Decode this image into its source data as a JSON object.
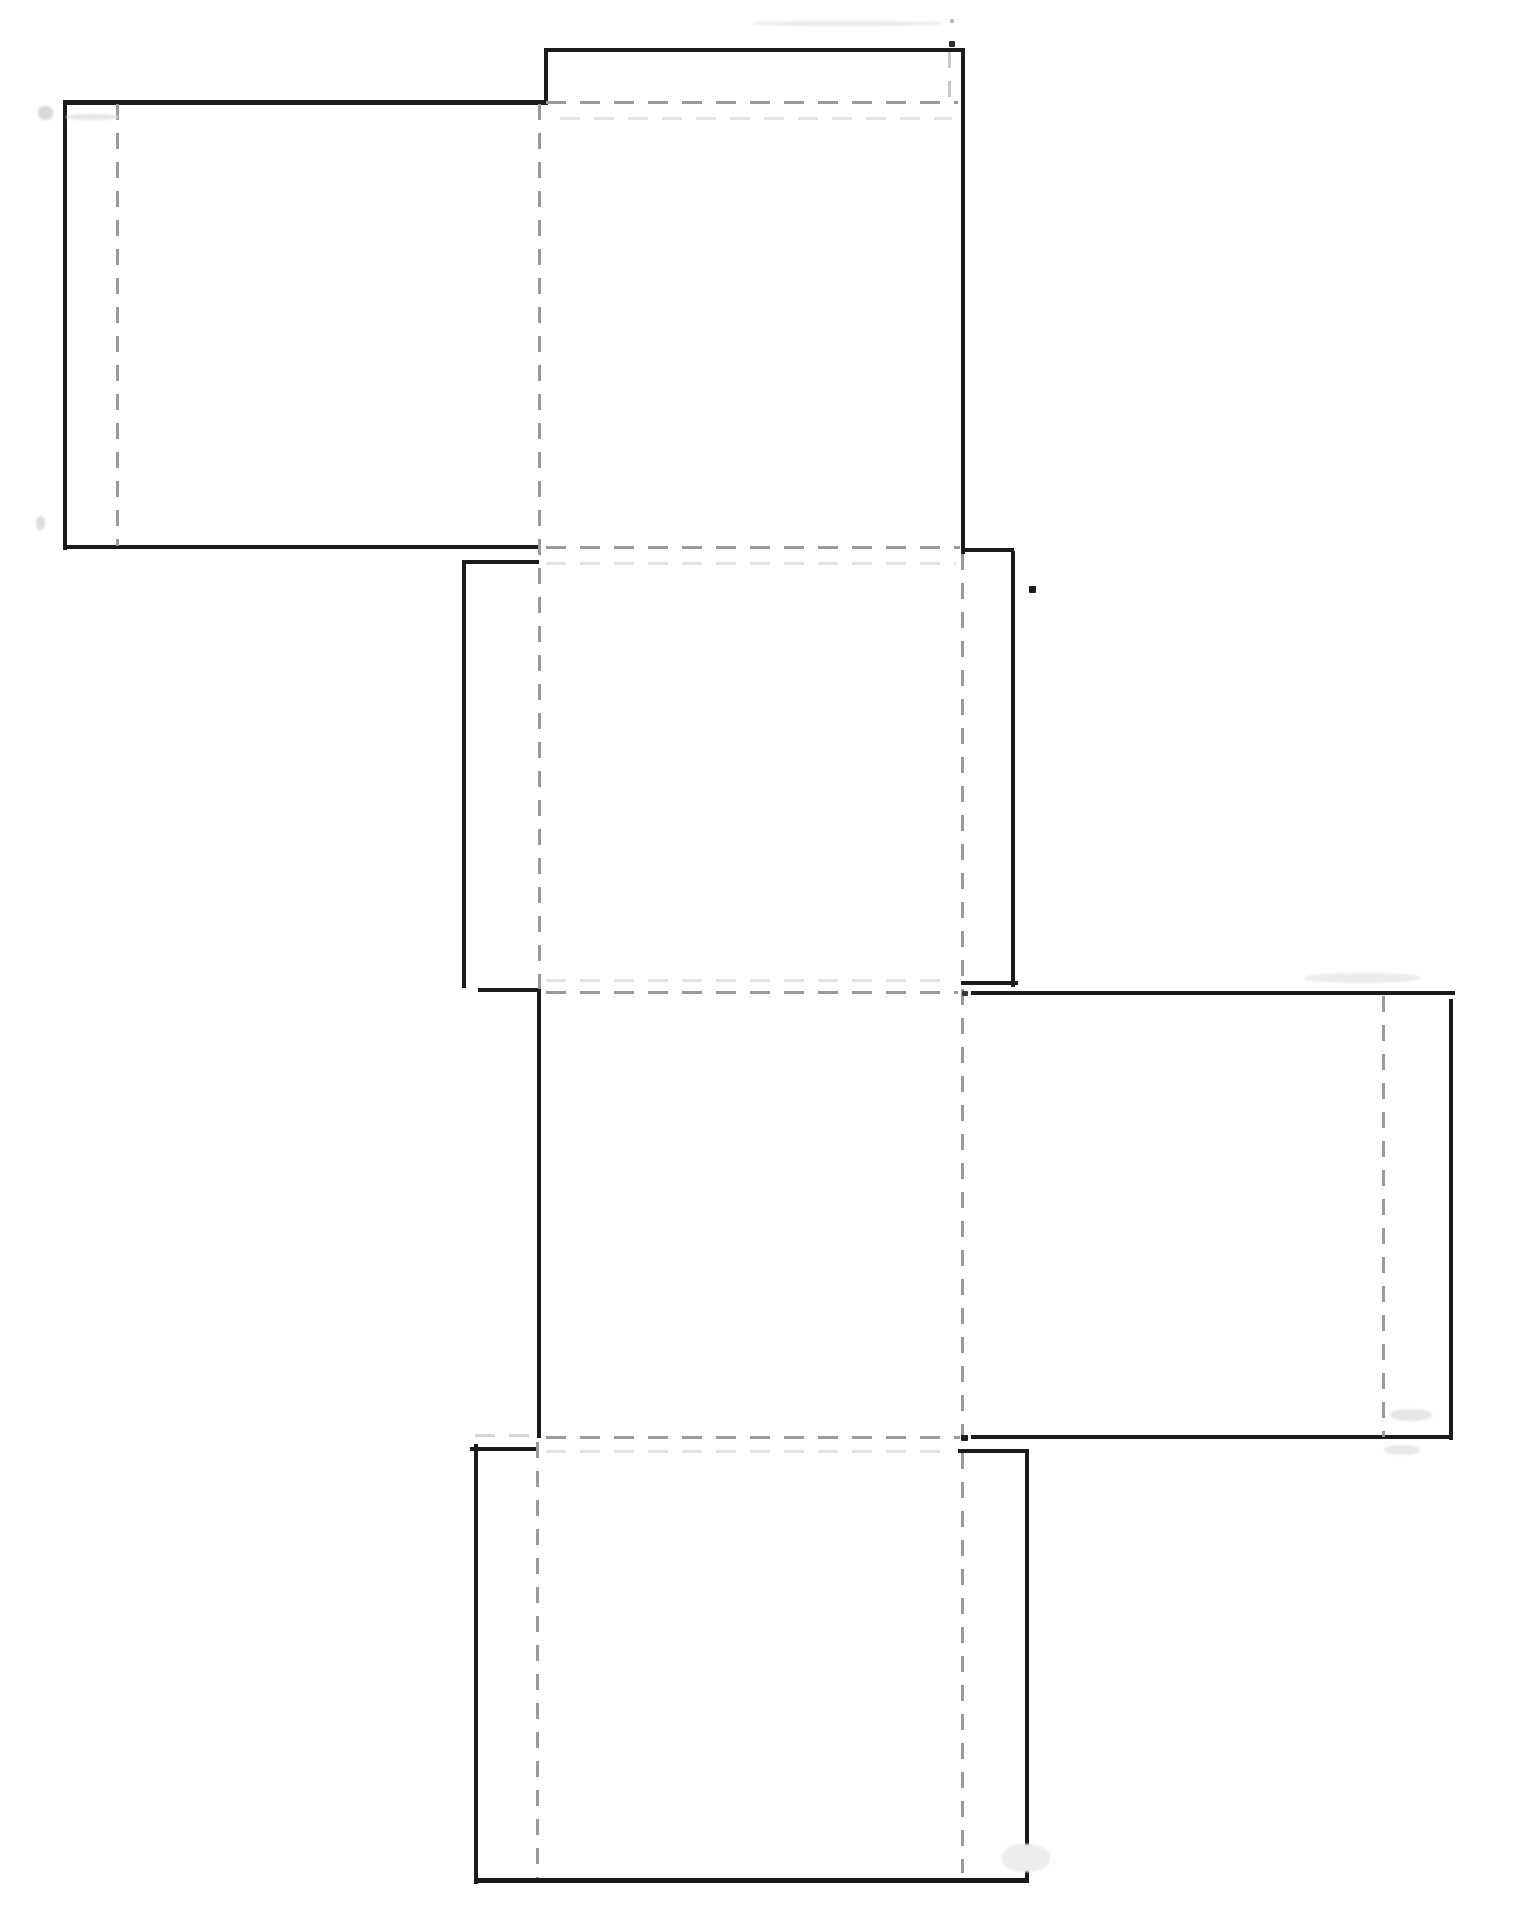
{
  "meta": {
    "title": "Cube box template net — solid cut lines and dashed fold lines",
    "canvas_width": 1524,
    "canvas_height": 1915,
    "background_color": "#ffffff"
  },
  "style": {
    "cut_color": "#1b1b1b",
    "cut_thickness": 4,
    "fold_color": "#9a9a9a",
    "fold_thickness": 3,
    "faint_color": "#dedede",
    "dash_h": [
      20,
      14
    ],
    "dash_v": [
      16,
      13
    ]
  },
  "net": {
    "cut_lines": [
      {
        "id": "top-tab-top-edge",
        "o": "h",
        "x": 544,
        "y": 48,
        "len": 421
      },
      {
        "id": "top-tab-left-edge",
        "o": "v",
        "x": 544,
        "y": 48,
        "len": 57
      },
      {
        "id": "top-square-right-edge",
        "o": "v",
        "x": 961,
        "y": 48,
        "len": 506
      },
      {
        "id": "left-flap-top-edge",
        "o": "h",
        "x": 63,
        "y": 100,
        "len": 483,
        "w": 5
      },
      {
        "id": "left-flap-left-edge",
        "o": "v",
        "x": 63,
        "y": 100,
        "len": 450
      },
      {
        "id": "left-flap-bottom-edge",
        "o": "h",
        "x": 63,
        "y": 545,
        "len": 478
      },
      {
        "id": "middle-square-top-left-seg",
        "o": "h",
        "x": 462,
        "y": 560,
        "len": 77
      },
      {
        "id": "middle-square-left-edge",
        "o": "v",
        "x": 462,
        "y": 560,
        "len": 428
      },
      {
        "id": "middle-square-top-right-seg",
        "o": "h",
        "x": 961,
        "y": 548,
        "len": 53
      },
      {
        "id": "middle-square-right-edge",
        "o": "v",
        "x": 1011,
        "y": 551,
        "len": 436
      },
      {
        "id": "middle-square-bottom-right-seg",
        "o": "h",
        "x": 961,
        "y": 981,
        "len": 57
      },
      {
        "id": "middle-square-bottom-left-seg",
        "o": "h",
        "x": 478,
        "y": 988,
        "len": 63
      },
      {
        "id": "center-square-left-edge",
        "o": "v",
        "x": 537,
        "y": 990,
        "len": 448
      },
      {
        "id": "right-flap-top-edge",
        "o": "h",
        "x": 971,
        "y": 991,
        "len": 484
      },
      {
        "id": "right-flap-right-edge",
        "o": "v",
        "x": 1449,
        "y": 999,
        "len": 441
      },
      {
        "id": "right-flap-bottom-edge",
        "o": "h",
        "x": 971,
        "y": 1435,
        "len": 481
      },
      {
        "id": "bottom-square-top-left-seg",
        "o": "h",
        "x": 470,
        "y": 1447,
        "len": 67
      },
      {
        "id": "bottom-square-left-edge",
        "o": "v",
        "x": 474,
        "y": 1444,
        "len": 440
      },
      {
        "id": "bottom-square-top-right-seg",
        "o": "h",
        "x": 958,
        "y": 1449,
        "len": 71
      },
      {
        "id": "bottom-square-right-edge",
        "o": "v",
        "x": 1025,
        "y": 1450,
        "len": 432
      },
      {
        "id": "bottom-square-bottom-edge",
        "o": "h",
        "x": 474,
        "y": 1878,
        "len": 555,
        "w": 5
      }
    ],
    "fold_lines": [
      {
        "id": "left-flap-tab-fold",
        "o": "v",
        "x": 116,
        "y": 104,
        "len": 442
      },
      {
        "id": "top-tab-fold",
        "o": "h",
        "x": 546,
        "y": 101,
        "len": 412
      },
      {
        "id": "top-tab-inner-fold-faint",
        "o": "v",
        "x": 948,
        "y": 52,
        "len": 51,
        "color": "#c9c9c9"
      },
      {
        "id": "column-left-fold-upper",
        "o": "v",
        "x": 538,
        "y": 104,
        "len": 885
      },
      {
        "id": "top-square-bottom-fold",
        "o": "h",
        "x": 546,
        "y": 546,
        "len": 414
      },
      {
        "id": "column-right-fold",
        "o": "v",
        "x": 961,
        "y": 554,
        "len": 1319
      },
      {
        "id": "middle-square-bottom-fold",
        "o": "h",
        "x": 546,
        "y": 991,
        "len": 412
      },
      {
        "id": "right-flap-tab-fold",
        "o": "v",
        "x": 1382,
        "y": 996,
        "len": 441
      },
      {
        "id": "center-square-bottom-fold",
        "o": "h",
        "x": 546,
        "y": 1436,
        "len": 414
      },
      {
        "id": "center-square-bottom-fold-faint",
        "o": "h",
        "x": 475,
        "y": 1434,
        "len": 60,
        "color": "#d6d6d6"
      },
      {
        "id": "column-left-fold-lower",
        "o": "v",
        "x": 536,
        "y": 1442,
        "len": 436
      },
      {
        "id": "echo-fold-top",
        "o": "h",
        "x": 560,
        "y": 117,
        "len": 392,
        "color": "#e3e3e3"
      },
      {
        "id": "echo-fold-upper-middle",
        "o": "h",
        "x": 546,
        "y": 562,
        "len": 410,
        "color": "#e3e3e3"
      },
      {
        "id": "echo-fold-lower-middle",
        "o": "h",
        "x": 546,
        "y": 979,
        "len": 406,
        "color": "#e3e3e3"
      },
      {
        "id": "echo-fold-bottom",
        "o": "h",
        "x": 546,
        "y": 1450,
        "len": 406,
        "color": "#e3e3e3"
      }
    ],
    "marks": [
      {
        "id": "stray-dot-top",
        "type": "dot",
        "x": 949,
        "y": 41,
        "w": 6,
        "h": 6,
        "color": "#2a2a2a"
      },
      {
        "id": "stray-dot-top-faint",
        "type": "dot",
        "x": 950,
        "y": 19,
        "w": 4,
        "h": 4,
        "color": "#bfbfbf"
      },
      {
        "id": "smear-top-edge",
        "type": "smear",
        "x": 752,
        "y": 21,
        "w": 190,
        "h": 5,
        "color": "#ebebeb"
      },
      {
        "id": "squiggle-left-top",
        "type": "smear",
        "x": 38,
        "y": 106,
        "w": 15,
        "h": 14,
        "color": "#d9d9d9"
      },
      {
        "id": "squiggle-left-middle",
        "type": "smear",
        "x": 36,
        "y": 516,
        "w": 9,
        "h": 14,
        "color": "#dddddd"
      },
      {
        "id": "stray-dot-right-middle",
        "type": "dot",
        "x": 1029,
        "y": 586,
        "w": 7,
        "h": 7,
        "color": "#1b1b1b"
      },
      {
        "id": "junction-dot-middle-fold",
        "type": "dot",
        "x": 962,
        "y": 991,
        "w": 6,
        "h": 5,
        "color": "#3a3a3a"
      },
      {
        "id": "junction-dot-bottom-fold",
        "type": "dot",
        "x": 961,
        "y": 1435,
        "w": 7,
        "h": 6,
        "color": "#1b1b1b"
      },
      {
        "id": "smear-right-flap-top",
        "type": "smear",
        "x": 1305,
        "y": 973,
        "w": 115,
        "h": 10,
        "color": "#ececec"
      },
      {
        "id": "smear-right-flap-inner",
        "type": "smear",
        "x": 1390,
        "y": 1409,
        "w": 42,
        "h": 12,
        "color": "#e6e6e6"
      },
      {
        "id": "smear-right-flap-below",
        "type": "smear",
        "x": 1384,
        "y": 1445,
        "w": 36,
        "h": 10,
        "color": "#e8e8e8"
      },
      {
        "id": "smear-bottom-square",
        "type": "smear",
        "x": 1002,
        "y": 1844,
        "w": 48,
        "h": 28,
        "color": "#ededed"
      },
      {
        "id": "smear-left-tab",
        "type": "smear",
        "x": 66,
        "y": 114,
        "w": 52,
        "h": 6,
        "color": "#e7e7e7"
      }
    ]
  }
}
